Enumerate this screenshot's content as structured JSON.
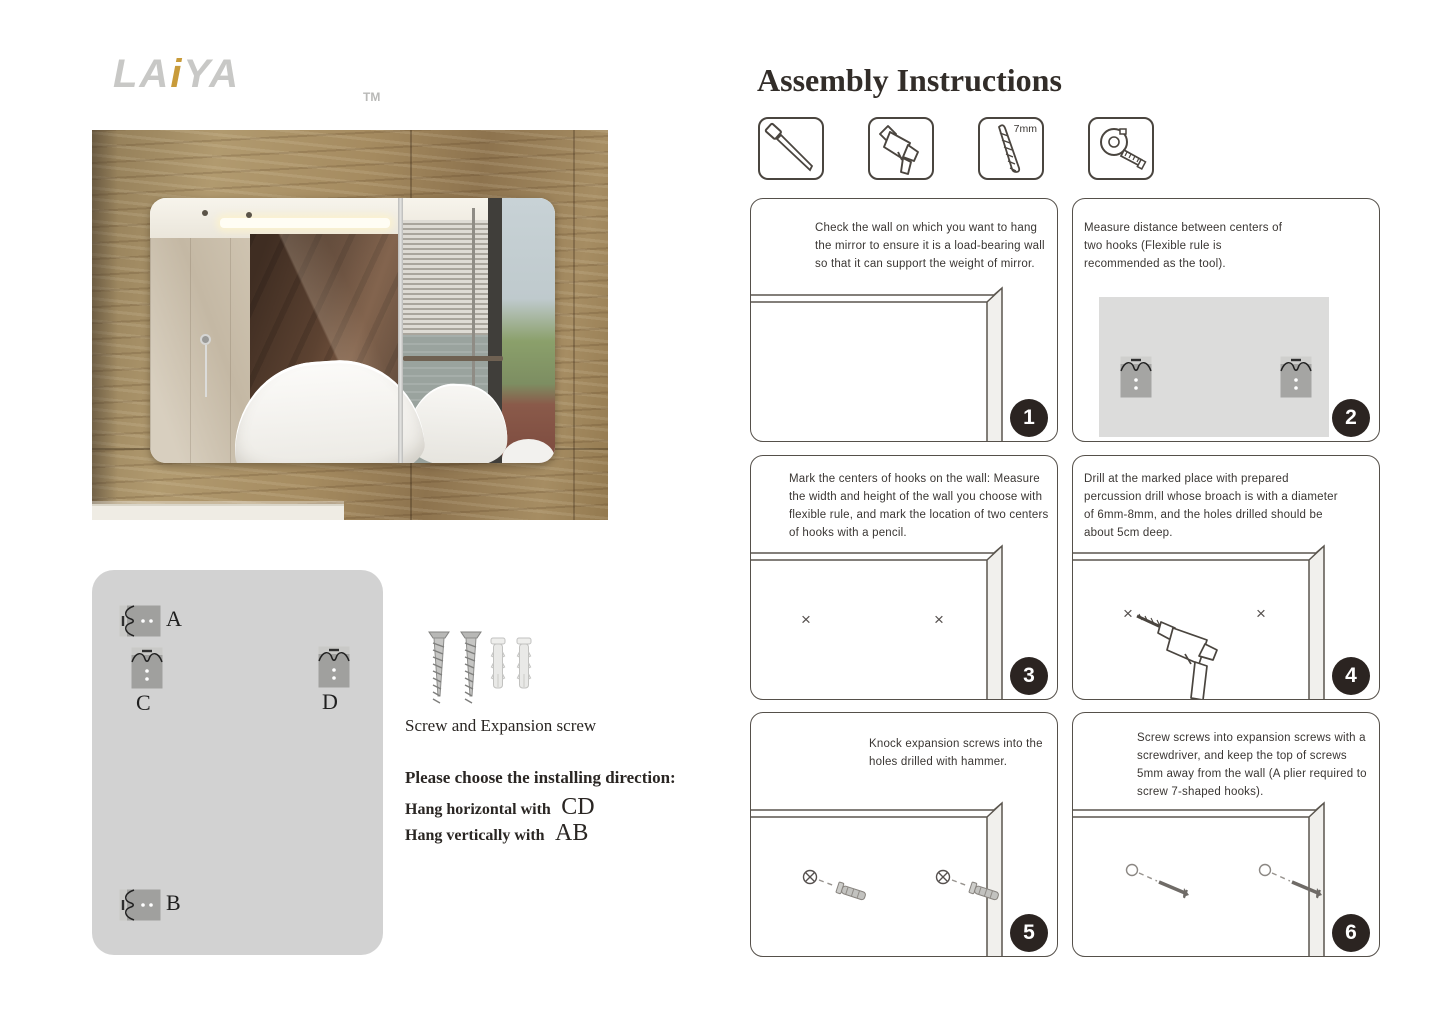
{
  "brand": {
    "name_prefix": "LA",
    "name_accent": "i",
    "name_suffix": "YA",
    "trademark": "TM"
  },
  "colors": {
    "accent_gold": "#c89b3a",
    "logo_gray": "#c8c8c6",
    "panel_border": "#55504a",
    "badge_bg": "#2b2421",
    "body_text": "#3a3633",
    "hook_panel_bg": "#d2d2d2"
  },
  "left": {
    "hooks": [
      {
        "label": "A",
        "orientation": "horizontal"
      },
      {
        "label": "C",
        "orientation": "vertical"
      },
      {
        "label": "D",
        "orientation": "vertical"
      },
      {
        "label": "B",
        "orientation": "horizontal"
      }
    ],
    "screw_caption": "Screw and Expansion screw",
    "direction_heading": "Please choose the installing direction:",
    "directions": [
      {
        "prefix": "Hang horizontal with",
        "code": "CD"
      },
      {
        "prefix": "Hang vertically with",
        "code": "AB"
      }
    ]
  },
  "instructions": {
    "title": "Assembly Instructions",
    "tools": [
      {
        "name": "screwdriver-awl"
      },
      {
        "name": "electric-drill"
      },
      {
        "name": "drill-bit",
        "label": "7mm"
      },
      {
        "name": "tape-measure"
      }
    ],
    "steps": [
      {
        "number": "1",
        "text": "Check the wall on which you want to hang the mirror to ensure it is a load-bearing wall so that it can support the weight of mirror."
      },
      {
        "number": "2",
        "text": "Measure distance between centers of two hooks (Flexible rule is recommended as the tool)."
      },
      {
        "number": "3",
        "text": "Mark the centers of hooks on the wall: Measure the width and height of the wall you choose with flexible rule, and mark the location of two centers of hooks with a pencil."
      },
      {
        "number": "4",
        "text": "Drill at the marked place with prepared percussion drill whose broach is with a diameter of 6mm-8mm, and the holes drilled should be about 5cm deep."
      },
      {
        "number": "5",
        "text": "Knock expansion screws into the holes drilled with hammer."
      },
      {
        "number": "6",
        "text": "Screw screws into expansion screws with a screwdriver, and keep the top of screws 5mm away from the wall (A plier required to screw 7-shaped hooks)."
      }
    ]
  }
}
